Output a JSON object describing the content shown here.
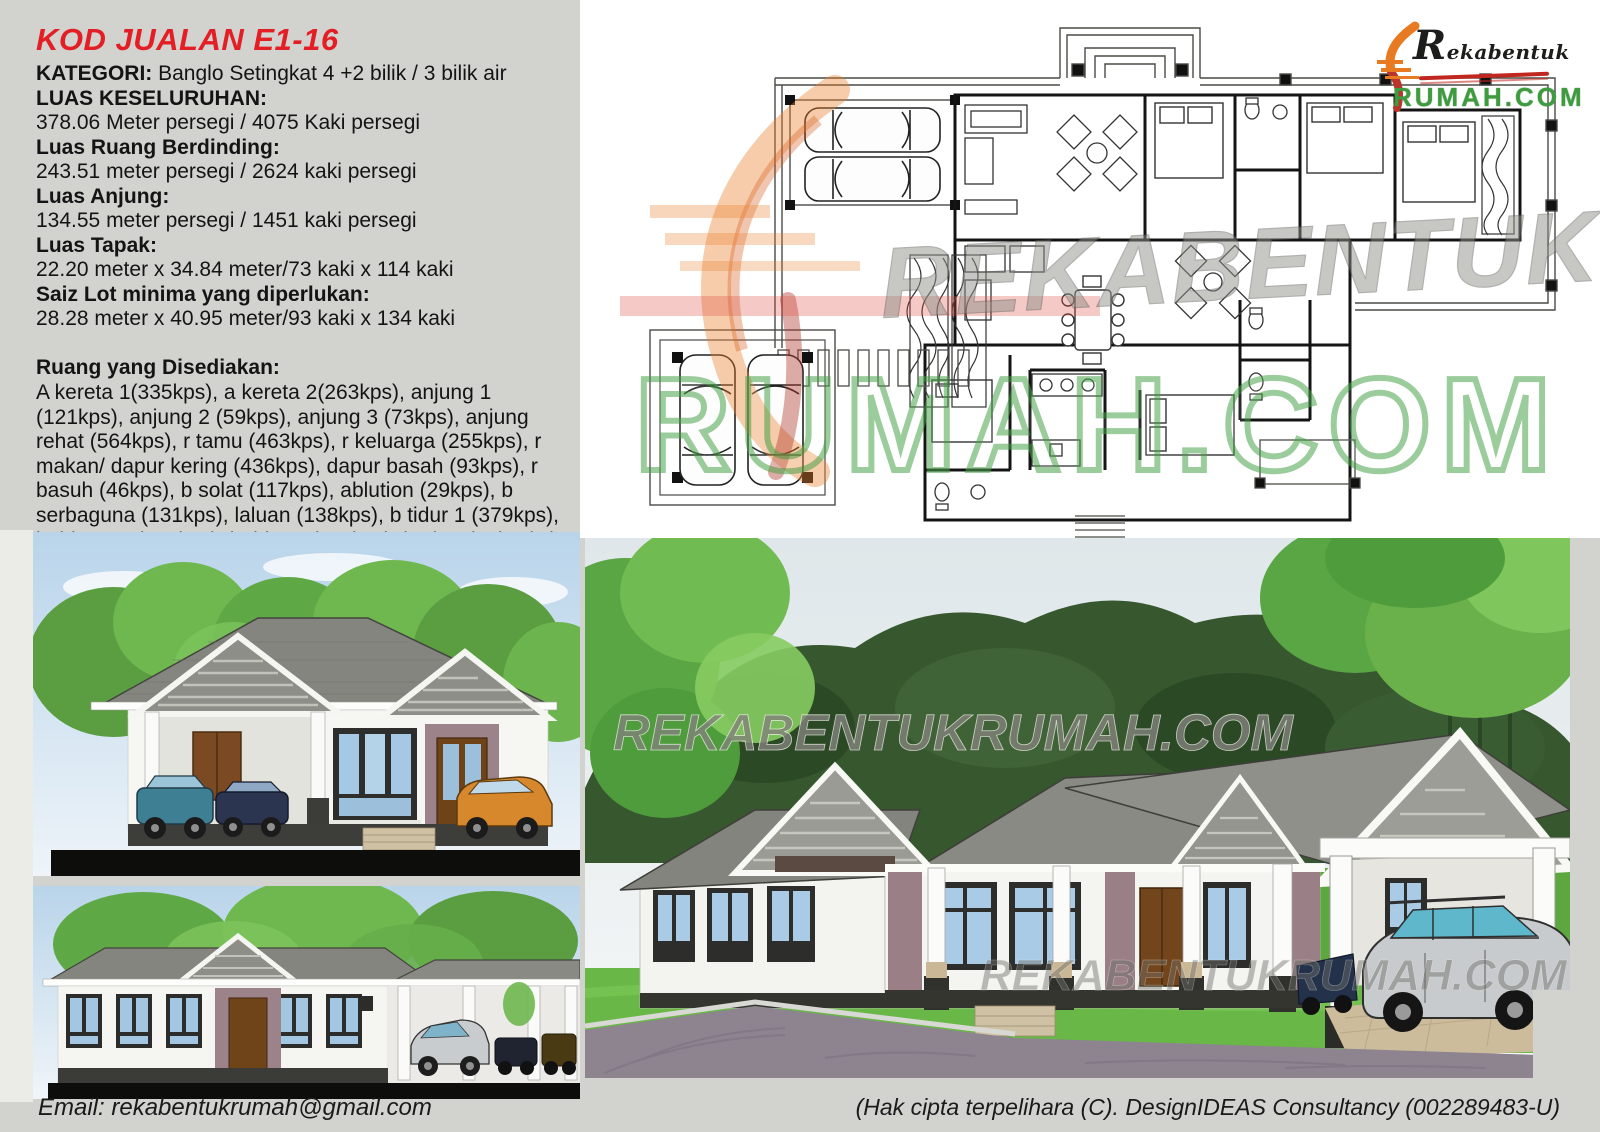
{
  "info": {
    "code": "KOD JUALAN E1-16",
    "category_label": "KATEGORI:",
    "category_value": " Banglo Setingkat 4 +2 bilik / 3 bilik air",
    "specs": [
      {
        "label": "LUAS KESELURUHAN:",
        "value": "378.06 Meter persegi / 4075 Kaki persegi"
      },
      {
        "label": "Luas Ruang Berdinding:",
        "value": "243.51 meter persegi / 2624 kaki persegi"
      },
      {
        "label": "Luas Anjung:",
        "value": "134.55 meter persegi / 1451 kaki persegi"
      },
      {
        "label": "Luas Tapak:",
        "value": "22.20 meter x 34.84 meter/73 kaki x 114 kaki"
      },
      {
        "label": "Saiz Lot minima yang diperlukan:",
        "value": "28.28 meter x 40.95 meter/93 kaki x 134 kaki"
      }
    ],
    "rooms_label": "Ruang yang Disediakan:",
    "rooms_text": "A kereta 1(335kps), a kereta 2(263kps), anjung 1 (121kps), anjung 2 (59kps), anjung 3 (73kps), anjung rehat (564kps), r tamu (463kps), r keluarga (255kps), r makan/ dapur kering (436kps), dapur basah (93kps), r basuh (46kps), b solat (117kps), ablution (29kps), b serbaguna (131kps), laluan (138kps), b tidur 1 (379kps), b tidur 2-3 (132kps), b tidur 4 (119kps), b air 1 (77kps), b air 2 (49kps) & b air 3 (27kps)"
  },
  "logo": {
    "line1": "Rekabentuk",
    "line2": "RUMAH.COM"
  },
  "watermarks": {
    "plan_brand": "REKABENTUK",
    "plan_domain": "RUMAH.COM",
    "render_url": "REKABENTUKRUMAH.COM"
  },
  "footer": {
    "email": "Email: rekabentukrumah@gmail.com",
    "copyright": "(Hak cipta terpelihara (C). DesignIDEAS Consultancy (002289483-U)"
  },
  "colors": {
    "accent_red": "#e31e24",
    "logo_green": "#3f9b3f",
    "logo_black": "#1d1d1b",
    "swoosh_orange": "#e87a22",
    "watermark_green": "#4aa34a",
    "page_bg": "#d2d2cf",
    "roof_gray": "#8a8a84",
    "lawn_green": "#69b746",
    "road_mauve": "#8d8490",
    "sky_blue": "#cfe3f2"
  }
}
